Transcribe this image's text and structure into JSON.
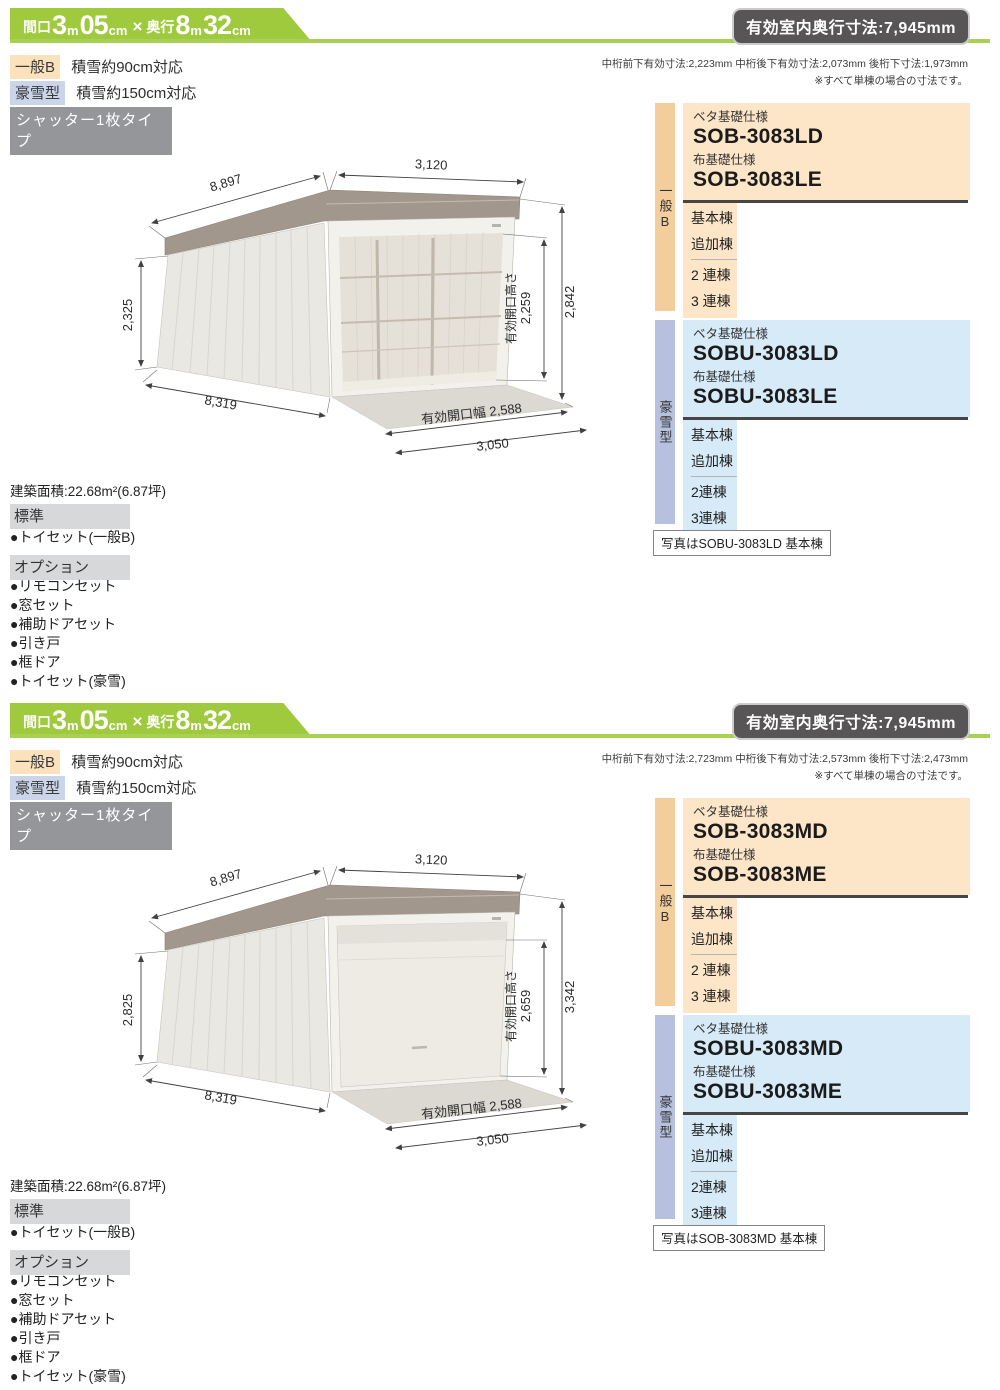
{
  "colors": {
    "accent_green": "#9fca3e",
    "underline_green": "#a8d154",
    "badge_gray": "#575555",
    "peach_box": "#fde5c8",
    "peach_tab": "#f3cd9c",
    "peach_label": "#fbe2bd",
    "blue_box": "#d6eaf8",
    "blue_tab": "#b7c1df",
    "blue_label": "#cbd5ea",
    "bar_gray": "#d7d8d9",
    "shutter_gray": "#949699"
  },
  "sections": [
    {
      "banner": {
        "parts": [
          "間口",
          "3",
          "m",
          "05",
          "cm",
          "×",
          "奥行",
          "8",
          "m",
          "32",
          "cm"
        ]
      },
      "badge": "有効室内奥行寸法:7,945mm",
      "notes": [
        "中桁前下有効寸法:2,223mm 中桁後下有効寸法:2,073mm 後桁下寸法:1,973mm",
        "※すべて単棟の場合の寸法です。"
      ],
      "spec_labels": [
        {
          "badge": "一般B",
          "text": "積雪約90cm対応"
        },
        {
          "badge": "豪雪型",
          "text": "積雪約150cm対応"
        }
      ],
      "shutter_type": "シャッター1枚タイプ",
      "drawing": {
        "view": "open-shutter",
        "dims": {
          "front_width": "3,120",
          "roof_depth": "8,897",
          "left_height": "2,325",
          "floor_depth": "8,319",
          "total_height": "2,842",
          "opening_height_label": "有効開口高さ",
          "opening_height": "2,259",
          "opening_width": "有効開口幅 2,588",
          "bottom_width": "3,050"
        }
      },
      "products": [
        {
          "tab": "一般B",
          "beta_label": "ベタ基礎仕様",
          "beta_model": "SOB-3083LD",
          "nuno_label": "布基礎仕様",
          "nuno_model": "SOB-3083LE",
          "rows1": [
            "基本棟",
            "追加棟"
          ],
          "rows2": [
            "2 連棟",
            "3 連棟"
          ]
        },
        {
          "tab": "豪雪型",
          "beta_label": "ベタ基礎仕様",
          "beta_model": "SOBU-3083LD",
          "nuno_label": "布基礎仕様",
          "nuno_model": "SOBU-3083LE",
          "rows1": [
            "基本棟",
            "追加棟"
          ],
          "rows2": [
            "2連棟",
            "3連棟"
          ]
        }
      ],
      "photo_caption": "写真はSOBU-3083LD 基本棟",
      "area": "建築面積:22.68m²(6.87坪)",
      "standard": {
        "header": "標準",
        "items": [
          "●トイセット(一般B)"
        ]
      },
      "options": {
        "header": "オプション",
        "items": [
          "●リモコンセット",
          "●窓セット",
          "●補助ドアセット",
          "●引き戸",
          "●框ドア",
          "●トイセット(豪雪)"
        ]
      }
    },
    {
      "banner": {
        "parts": [
          "間口",
          "3",
          "m",
          "05",
          "cm",
          "×",
          "奥行",
          "8",
          "m",
          "32",
          "cm"
        ]
      },
      "badge": "有効室内奥行寸法:7,945mm",
      "notes": [
        "中桁前下有効寸法:2,723mm 中桁後下有効寸法:2,573mm 後桁下寸法:2,473mm",
        "※すべて単棟の場合の寸法です。"
      ],
      "spec_labels": [
        {
          "badge": "一般B",
          "text": "積雪約90cm対応"
        },
        {
          "badge": "豪雪型",
          "text": "積雪約150cm対応"
        }
      ],
      "shutter_type": "シャッター1枚タイプ",
      "drawing": {
        "view": "closed-shutter",
        "dims": {
          "front_width": "3,120",
          "roof_depth": "8,897",
          "left_height": "2,825",
          "floor_depth": "8,319",
          "total_height": "3,342",
          "opening_height_label": "有効開口高さ",
          "opening_height": "2,659",
          "opening_width": "有効開口幅 2,588",
          "bottom_width": "3,050"
        }
      },
      "products": [
        {
          "tab": "一般B",
          "beta_label": "ベタ基礎仕様",
          "beta_model": "SOB-3083MD",
          "nuno_label": "布基礎仕様",
          "nuno_model": "SOB-3083ME",
          "rows1": [
            "基本棟",
            "追加棟"
          ],
          "rows2": [
            "2 連棟",
            "3 連棟"
          ]
        },
        {
          "tab": "豪雪型",
          "beta_label": "ベタ基礎仕様",
          "beta_model": "SOBU-3083MD",
          "nuno_label": "布基礎仕様",
          "nuno_model": "SOBU-3083ME",
          "rows1": [
            "基本棟",
            "追加棟"
          ],
          "rows2": [
            "2連棟",
            "3連棟"
          ]
        }
      ],
      "photo_caption": "写真はSOB-3083MD 基本棟",
      "area": "建築面積:22.68m²(6.87坪)",
      "standard": {
        "header": "標準",
        "items": [
          "●トイセット(一般B)"
        ]
      },
      "options": {
        "header": "オプション",
        "items": [
          "●リモコンセット",
          "●窓セット",
          "●補助ドアセット",
          "●引き戸",
          "●框ドア",
          "●トイセット(豪雪)"
        ]
      }
    }
  ]
}
